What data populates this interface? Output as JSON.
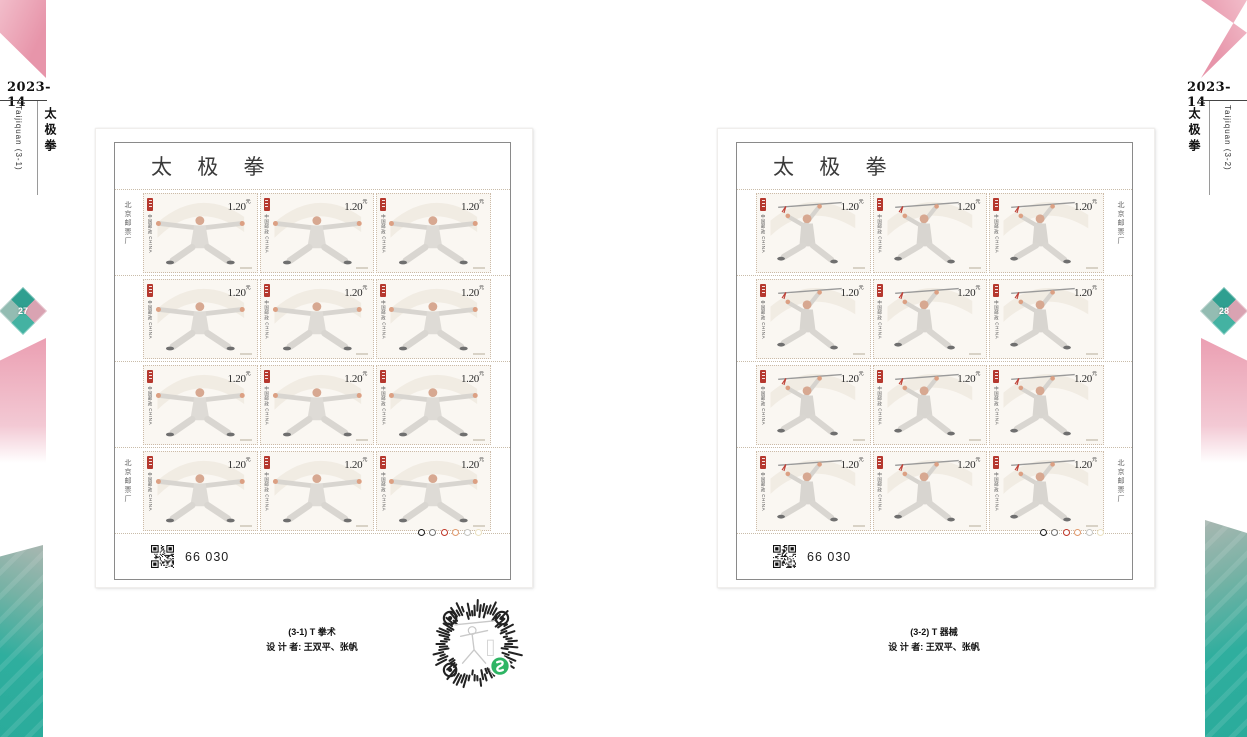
{
  "sidebars": {
    "left": {
      "issue": "2023-14",
      "title_cn": "太极拳",
      "title_en": "Taijiquan (3-1)",
      "page_number": "27"
    },
    "right": {
      "issue": "2023-14",
      "title_cn": "太极拳",
      "title_en": "Taijiquan (3-2)",
      "page_number": "28"
    }
  },
  "sheets": [
    {
      "title": "太 极 拳",
      "margin_text": "北京邮票厂",
      "sheet_number": "66 030",
      "rows": 4,
      "cols": 3,
      "stamp": {
        "denomination": "1.20",
        "currency": "元",
        "country_text": "中国邮政 CHINA",
        "pose": "horse-stance-arms-spread"
      },
      "color_dots": [
        "#1a1a1a",
        "#757575",
        "#c0392b",
        "#e09a6e",
        "#c6c6c2",
        "#ece3c4"
      ],
      "caption_line1": "(3-1) T 拳术",
      "caption_line2": "设 计 者: 王双平、张帆"
    },
    {
      "title": "太 极 拳",
      "margin_text": "北京邮票厂",
      "sheet_number": "66 030",
      "rows": 4,
      "cols": 3,
      "stamp": {
        "denomination": "1.20",
        "currency": "元",
        "country_text": "中国邮政 CHINA",
        "pose": "sword-overhead-lunge"
      },
      "color_dots": [
        "#1a1a1a",
        "#757575",
        "#c0392b",
        "#e09a6e",
        "#c6c6c2",
        "#ece3c4"
      ],
      "caption_line1": "(3-2) T 器械",
      "caption_line2": "设 计 者: 王双平、张帆"
    }
  ],
  "colors": {
    "ribbon_pink": "#e795aa",
    "ribbon_teal": "#2fae9e",
    "seal_red": "#b5382e",
    "miniprogram_green": "#2eb564"
  }
}
